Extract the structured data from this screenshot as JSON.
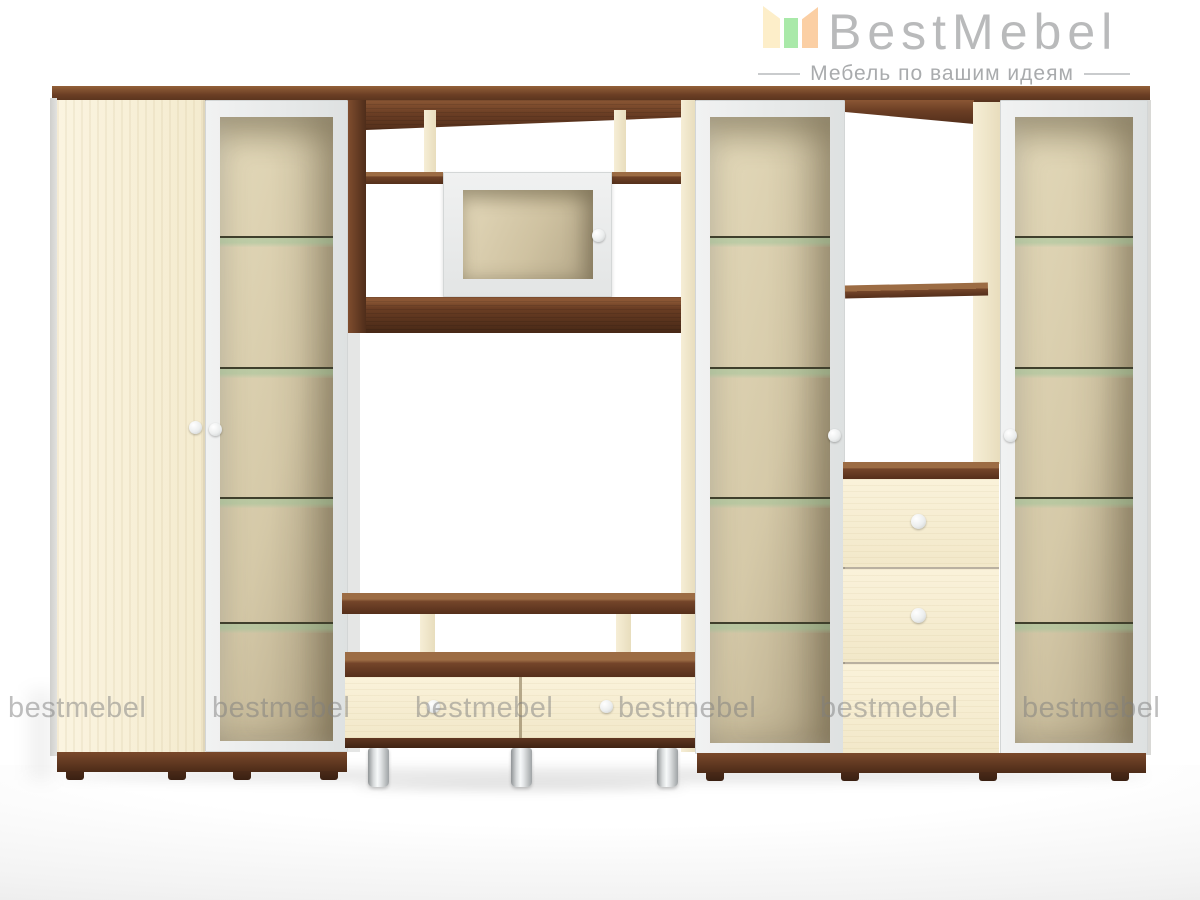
{
  "page": {
    "background": "#ffffff"
  },
  "logo": {
    "brand": "BestMebel",
    "tagline": "Мебель по вашим идеям",
    "icon": "open-book-icon"
  },
  "watermark": {
    "text": "bestmebel"
  },
  "theme": {
    "logo-text": "#b9babb",
    "logo-tagline": "#a9abad",
    "logo-line": "#c9cbcd",
    "logo-bar-left": "#fdeec9",
    "logo-bar-mid": "#a9e9a9",
    "logo-bar-right": "#fbcfa4",
    "watermark": "rgba(125,125,125,0.5)",
    "walnut": "#6b3e24",
    "cream": "#f8f0d6",
    "frame-white": "#eceeee",
    "glass-back-light": "#e4dabb",
    "glass-back-dark": "#b3a687",
    "shelf-tint": "rgba(150,195,150,0.45)",
    "knob": "#eceeee",
    "chrome": "#d7dadb"
  }
}
